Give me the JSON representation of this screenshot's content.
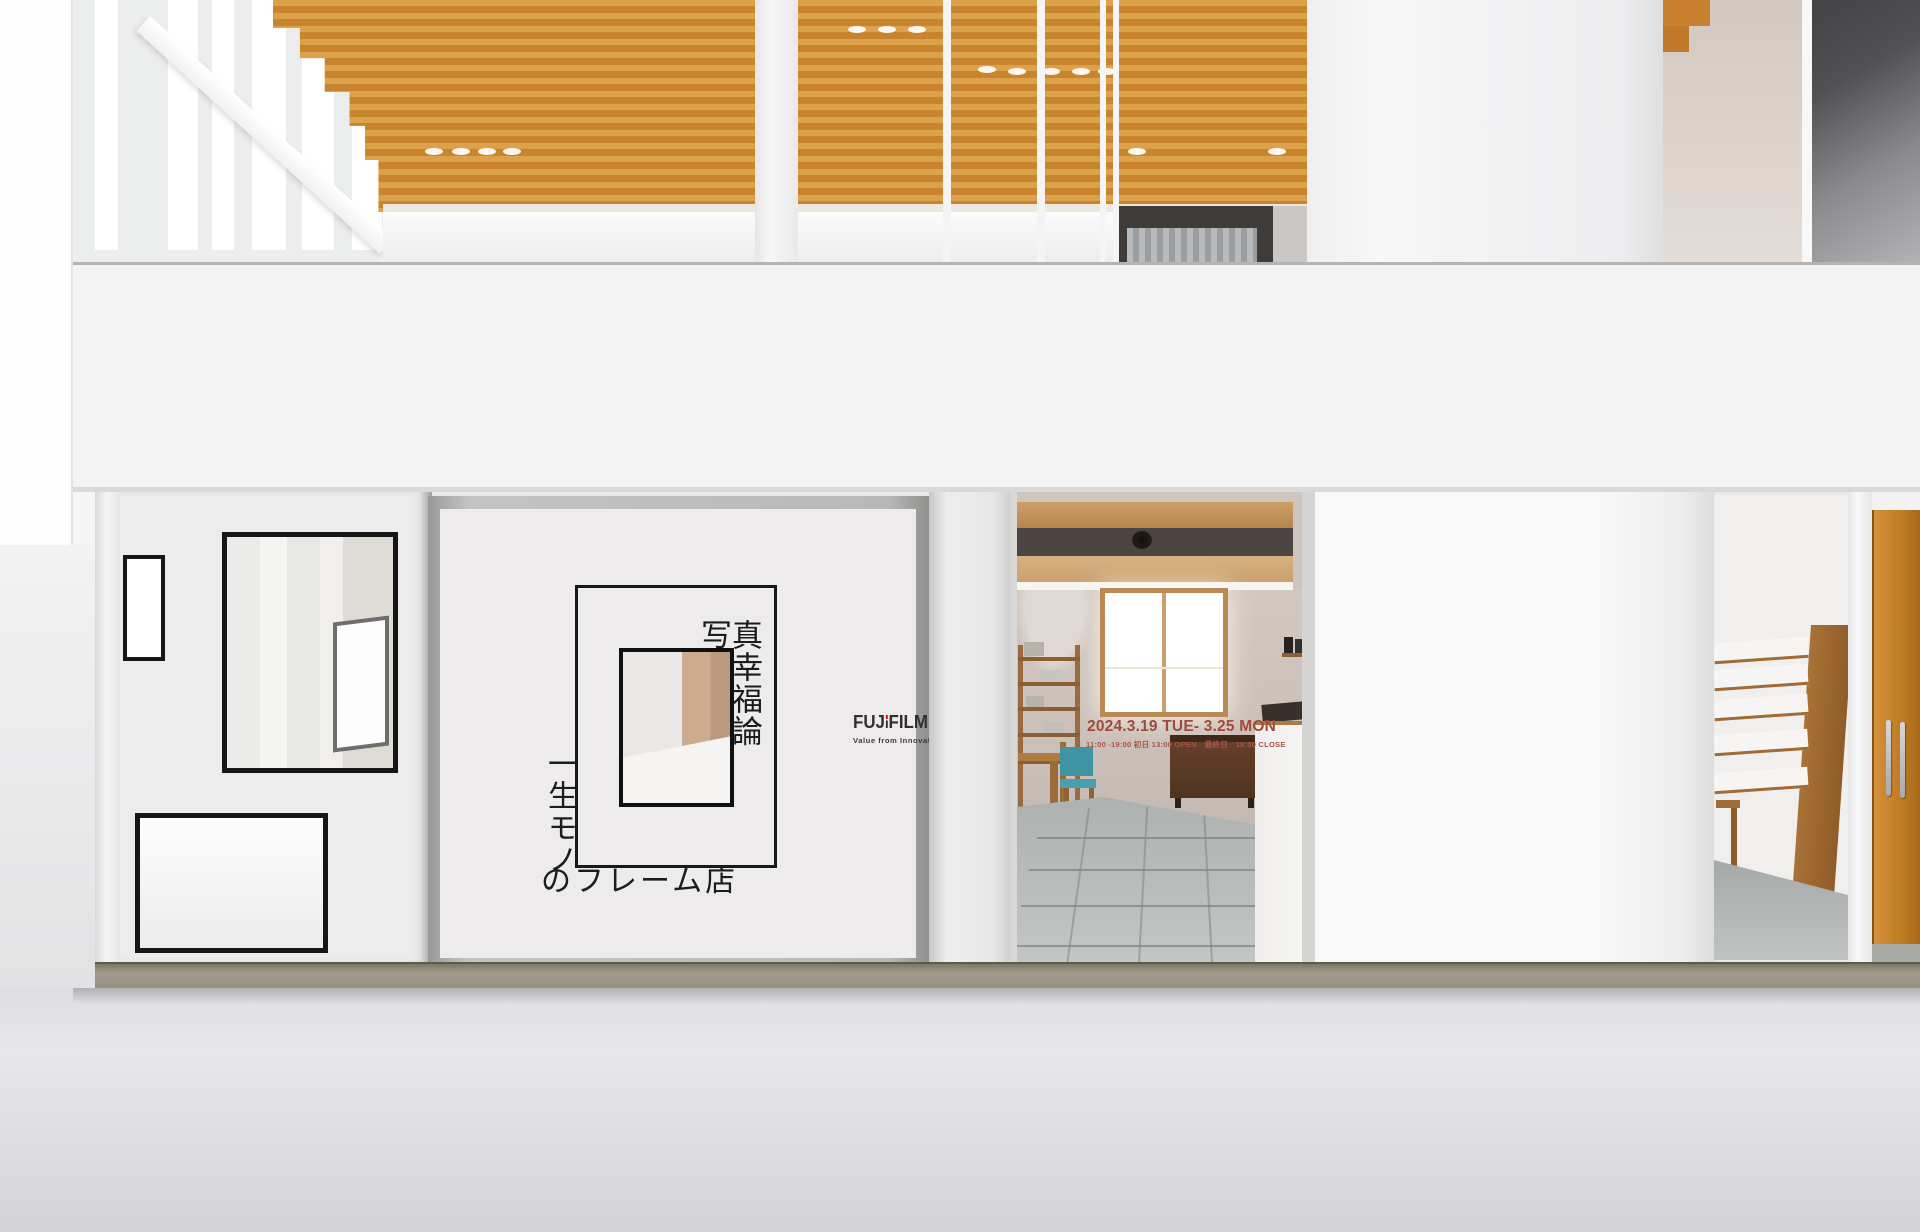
{
  "sign": {
    "kanji_top": "写",
    "kanji_column": "真幸福論",
    "kanji_side": "一生モノ",
    "kanji_bottom": "のフレーム店"
  },
  "logo": {
    "brand_prefix": "FUJ",
    "brand_suffix": "FILM",
    "tagline": "Value from Innovation"
  },
  "event": {
    "date_range": "2024.3.19 TUE- 3.25 MON",
    "hours": "11:00 -19:00 初日 13:00 OPEN　最終日　18:00 CLOSE"
  },
  "colors": {
    "accent_red": "#e60012",
    "event_text_red": "#a04a3c",
    "ceiling_wood": "#c9852e",
    "door_wood": "#c07d24",
    "chair_teal": "#3f93a3"
  }
}
